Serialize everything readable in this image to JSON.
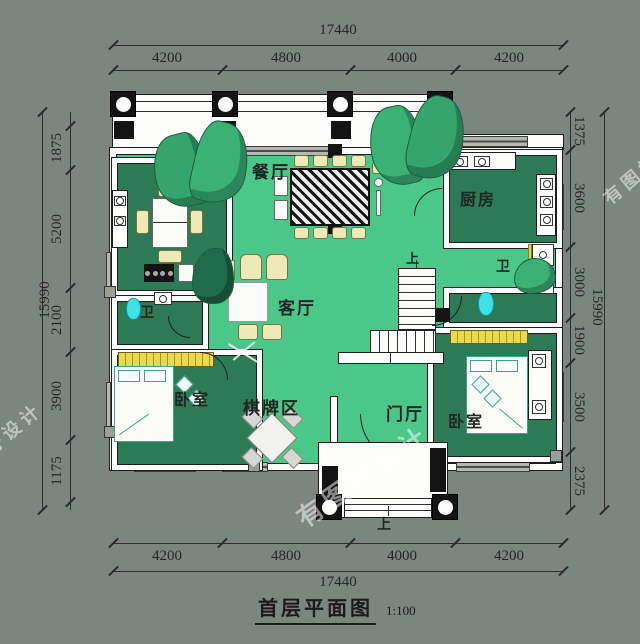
{
  "meta": {
    "title": "首层平面图",
    "scale": "1:100"
  },
  "dimensions": {
    "top": {
      "total": "17440",
      "segments": [
        "4200",
        "4800",
        "4000",
        "4200"
      ]
    },
    "bottom": {
      "total": "17440",
      "segments": [
        "4200",
        "4800",
        "4000",
        "4200"
      ]
    },
    "left": {
      "total": "15990",
      "segments": [
        "1875",
        "5200",
        "2100",
        "3900",
        "1175"
      ],
      "edge_partial": "1875"
    },
    "right": {
      "total": "15990",
      "segments": [
        "1375",
        "3600",
        "3000",
        "1900",
        "3500",
        "2375"
      ]
    }
  },
  "rooms": {
    "dining": "餐厅",
    "annex": "餐厅",
    "kitchen": "厨房",
    "bath_right": "卫",
    "bath_left": "卫",
    "living": "客厅",
    "games": "棋牌区",
    "foyer": "门厅",
    "bedroom_left": "卧室",
    "bedroom_right": "卧室"
  },
  "stairs": {
    "up": "上"
  },
  "entry": {
    "up": "上"
  },
  "watermark": "有图好设计",
  "colors": {
    "background": "#7c8680",
    "floor": "#4cc78a",
    "room_dark": "#2d7a57",
    "wall": "#fdfdfb",
    "line": "#1c1c1c",
    "fixture_cyan": "#3fe0e6",
    "wardrobe_yellow": "#e9d94e",
    "furniture_cream": "#efe9b8"
  }
}
